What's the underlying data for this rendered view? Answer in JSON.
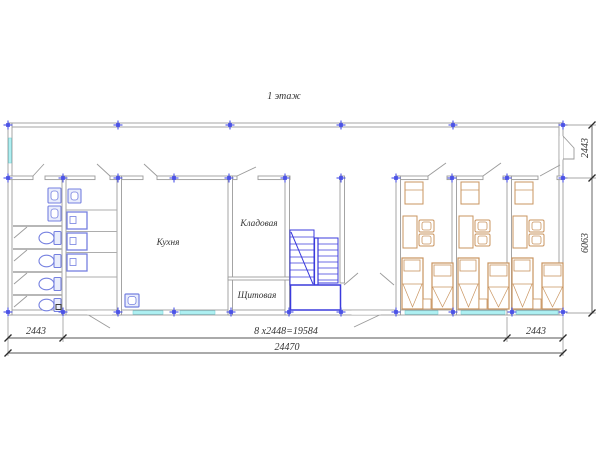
{
  "title": "1 этаж",
  "rooms": {
    "kitchen": {
      "label": "Кухня"
    },
    "storage": {
      "label": "Кладовая"
    },
    "electrical": {
      "label": "Щитовая"
    }
  },
  "dimensions": {
    "bottom_left": "2443",
    "bottom_center": "8 х2448=19584",
    "bottom_right": "2443",
    "bottom_total": "24470",
    "side_top": "2443",
    "side_main": "6063"
  },
  "colors": {
    "wall": "#9b9b9b",
    "fixture": "#7580e0",
    "stair": "#3b3bdc",
    "furniture": "#c9945f",
    "window": "#aef0f2",
    "marker": "#4a52e6",
    "dimension": "#555555"
  }
}
